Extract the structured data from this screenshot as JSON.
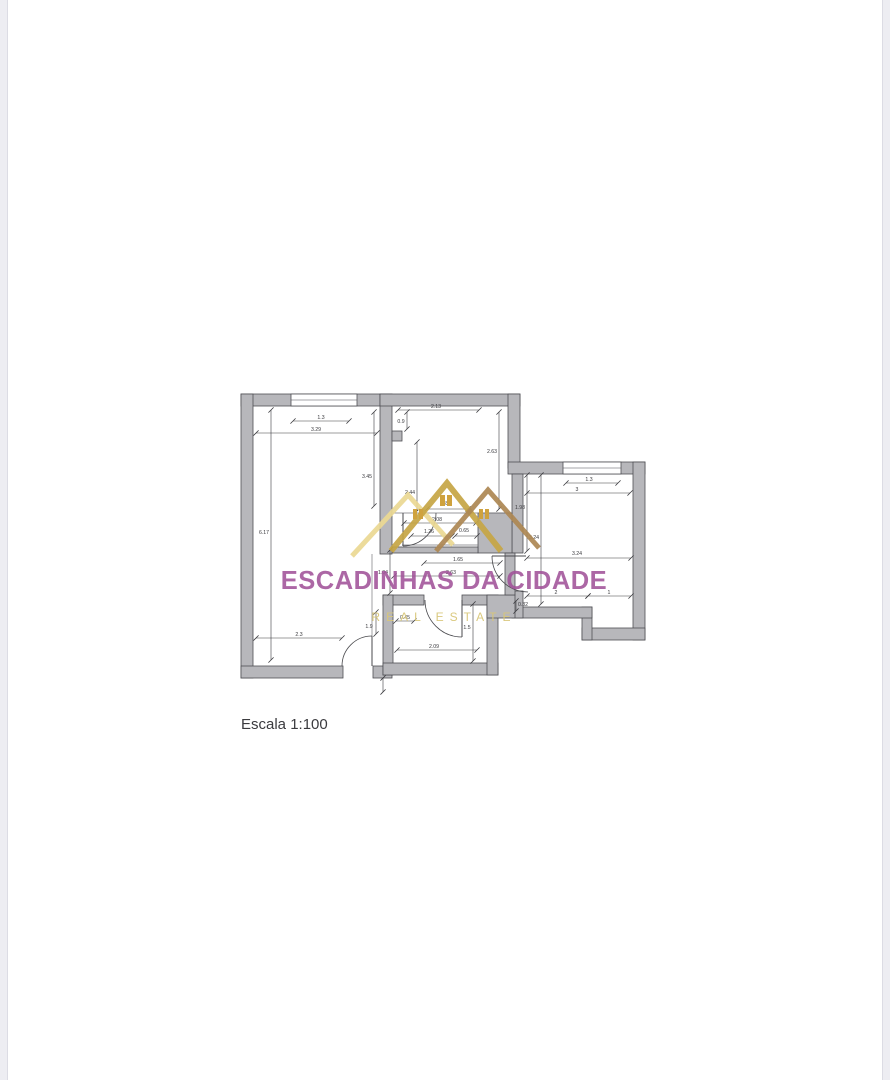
{
  "meta": {
    "scale_label": "Escala 1:100"
  },
  "colors": {
    "wall": "#b7b7bb",
    "wall_edge": "#4f4f54",
    "dim": "#3a3a3e",
    "line": "#77777c",
    "door": "#4a4a4e",
    "scale_text": "#3b3b3f"
  },
  "watermark": {
    "title": "ESCADINHAS DA CIDADE",
    "subtitle": "REAL ESTATE",
    "title_color": "rgba(160,82,153,0.88)",
    "subtitle_color": "rgba(216,198,120,0.95)"
  },
  "logo": {
    "window_color": "#cfa23e",
    "strokes": [
      {
        "pts": "352,556 408,495 453,545",
        "color": "#ead892",
        "w": 5
      },
      {
        "pts": "391,551 447,483 501,551",
        "color": "#c6a544",
        "w": 6
      },
      {
        "pts": "436,551 488,490 539,548",
        "color": "#ad8752",
        "w": 5
      }
    ],
    "windows": [
      {
        "x": 413,
        "y": 509,
        "bw": 4,
        "h": 10
      },
      {
        "x": 440,
        "y": 495,
        "bw": 5,
        "h": 11
      },
      {
        "x": 479,
        "y": 509,
        "bw": 4,
        "h": 10
      }
    ]
  },
  "plan": {
    "walls": [
      [
        241,
        394,
        151,
        12
      ],
      [
        241,
        394,
        12,
        284
      ],
      [
        241,
        666,
        102,
        12
      ],
      [
        373,
        666,
        19,
        12
      ],
      [
        380,
        394,
        12,
        160
      ],
      [
        380,
        394,
        140,
        12
      ],
      [
        508,
        394,
        12,
        74
      ],
      [
        508,
        462,
        137,
        12
      ],
      [
        633,
        462,
        12,
        178
      ],
      [
        582,
        628,
        63,
        12
      ],
      [
        582,
        607,
        10,
        33
      ],
      [
        512,
        607,
        80,
        11
      ],
      [
        512,
        474,
        11,
        79
      ],
      [
        512,
        591,
        11,
        27
      ],
      [
        478,
        513,
        34,
        40
      ],
      [
        392,
        547,
        86,
        6
      ],
      [
        383,
        595,
        41,
        10
      ],
      [
        462,
        595,
        36,
        10
      ],
      [
        383,
        595,
        10,
        80
      ],
      [
        383,
        663,
        115,
        12
      ],
      [
        487,
        595,
        11,
        80
      ],
      [
        487,
        595,
        28,
        23
      ],
      [
        505,
        553,
        10,
        42
      ],
      [
        392,
        431,
        10,
        10
      ]
    ],
    "windows": [
      {
        "x": 291,
        "y": 394,
        "w": 66,
        "h": 12
      },
      {
        "x": 563,
        "y": 462,
        "w": 58,
        "h": 12
      }
    ],
    "lines": [
      [
        393,
        513,
        510,
        513
      ],
      [
        402,
        545,
        478,
        545
      ],
      [
        372,
        554,
        372,
        636
      ]
    ],
    "doors": [
      {
        "leaf": [
          372,
          636,
          372,
          666
        ],
        "arc": "M 372 636 A 30 30 0 0 0 342 666"
      },
      {
        "leaf": [
          403,
          513,
          403,
          546
        ],
        "arc": "M 403 546 A 33 33 0 0 0 436 513"
      },
      {
        "leaf": [
          462,
          600,
          462,
          637
        ],
        "arc": "M 462 637 A 37 37 0 0 1 425 600"
      },
      {
        "leaf": [
          526,
          556,
          492,
          556
        ],
        "arc": "M 492 556 A 36 36 0 0 0 528 592"
      }
    ],
    "dims": [
      {
        "t": "1.3",
        "l": [
          293,
          421,
          349,
          421
        ],
        "p": [
          321,
          419
        ]
      },
      {
        "t": "3.29",
        "l": [
          256,
          433,
          377,
          433
        ],
        "p": [
          316,
          431
        ]
      },
      {
        "t": "6.17",
        "l": [
          271,
          410,
          271,
          660
        ],
        "p": [
          264,
          534
        ]
      },
      {
        "t": "3.45",
        "l": [
          374,
          412,
          374,
          506
        ],
        "p": [
          367,
          478
        ]
      },
      {
        "t": "2.3",
        "l": [
          256,
          638,
          342,
          638
        ],
        "p": [
          299,
          636
        ]
      },
      {
        "t": "1.9",
        "l": [
          376,
          612,
          376,
          634
        ],
        "p": [
          369,
          628
        ]
      },
      {
        "t": "",
        "l": [
          383,
          678,
          383,
          692
        ],
        "p": [
          0,
          0
        ]
      },
      {
        "t": "2.13",
        "l": [
          398,
          410,
          479,
          410
        ],
        "p": [
          436,
          408
        ]
      },
      {
        "t": "0.9",
        "l": [
          407,
          412,
          407,
          429
        ],
        "p": [
          401,
          423
        ]
      },
      {
        "t": "2.44",
        "l": [
          417,
          442,
          417,
          511
        ],
        "p": [
          410,
          494
        ]
      },
      {
        "t": "2.63",
        "l": [
          499,
          412,
          499,
          509
        ],
        "p": [
          492,
          453
        ]
      },
      {
        "t": "0.87",
        "l": [
          427,
          509,
          468,
          509
        ],
        "p": [
          446,
          505
        ]
      },
      {
        "t": "2.08",
        "l": [
          404,
          523,
          476,
          523
        ],
        "p": [
          437,
          521
        ]
      },
      {
        "t": "1.26",
        "l": [
          411,
          536,
          452,
          536
        ],
        "p": [
          429,
          533
        ]
      },
      {
        "t": "0.65",
        "l": [
          455,
          536,
          477,
          536
        ],
        "p": [
          464,
          532
        ]
      },
      {
        "t": "1.65",
        "l": [
          424,
          563,
          500,
          563
        ],
        "p": [
          458,
          561
        ]
      },
      {
        "t": "2.63",
        "l": [
          394,
          576,
          500,
          576
        ],
        "p": [
          451,
          574
        ]
      },
      {
        "t": "1.04",
        "l": [
          390,
          550,
          390,
          593
        ],
        "p": [
          383,
          574
        ]
      },
      {
        "t": "0.45",
        "l": [
          396,
          621,
          414,
          621
        ],
        "p": [
          405,
          619
        ]
      },
      {
        "t": "2.09",
        "l": [
          397,
          650,
          477,
          650
        ],
        "p": [
          434,
          648
        ]
      },
      {
        "t": "1.5",
        "l": [
          473,
          604,
          473,
          661
        ],
        "p": [
          467,
          629
        ]
      },
      {
        "t": "1.3",
        "l": [
          566,
          483,
          618,
          483
        ],
        "p": [
          589,
          481
        ]
      },
      {
        "t": "3",
        "l": [
          527,
          493,
          630,
          493
        ],
        "p": [
          577,
          491
        ]
      },
      {
        "t": "1.98",
        "l": [
          527,
          475,
          527,
          551
        ],
        "p": [
          520,
          509
        ]
      },
      {
        "t": "3.24",
        "l": [
          541,
          475,
          541,
          604
        ],
        "p": [
          534,
          539
        ]
      },
      {
        "t": "3.24",
        "l": [
          527,
          558,
          631,
          558
        ],
        "p": [
          577,
          555
        ]
      },
      {
        "t": "2",
        "l": [
          527,
          596,
          588,
          596
        ],
        "p": [
          556,
          594
        ]
      },
      {
        "t": "1",
        "l": [
          588,
          596,
          631,
          596
        ],
        "p": [
          609,
          594
        ]
      },
      {
        "t": "0.32",
        "l": [
          516,
          601,
          516,
          611
        ],
        "p": [
          523,
          606
        ]
      }
    ]
  }
}
